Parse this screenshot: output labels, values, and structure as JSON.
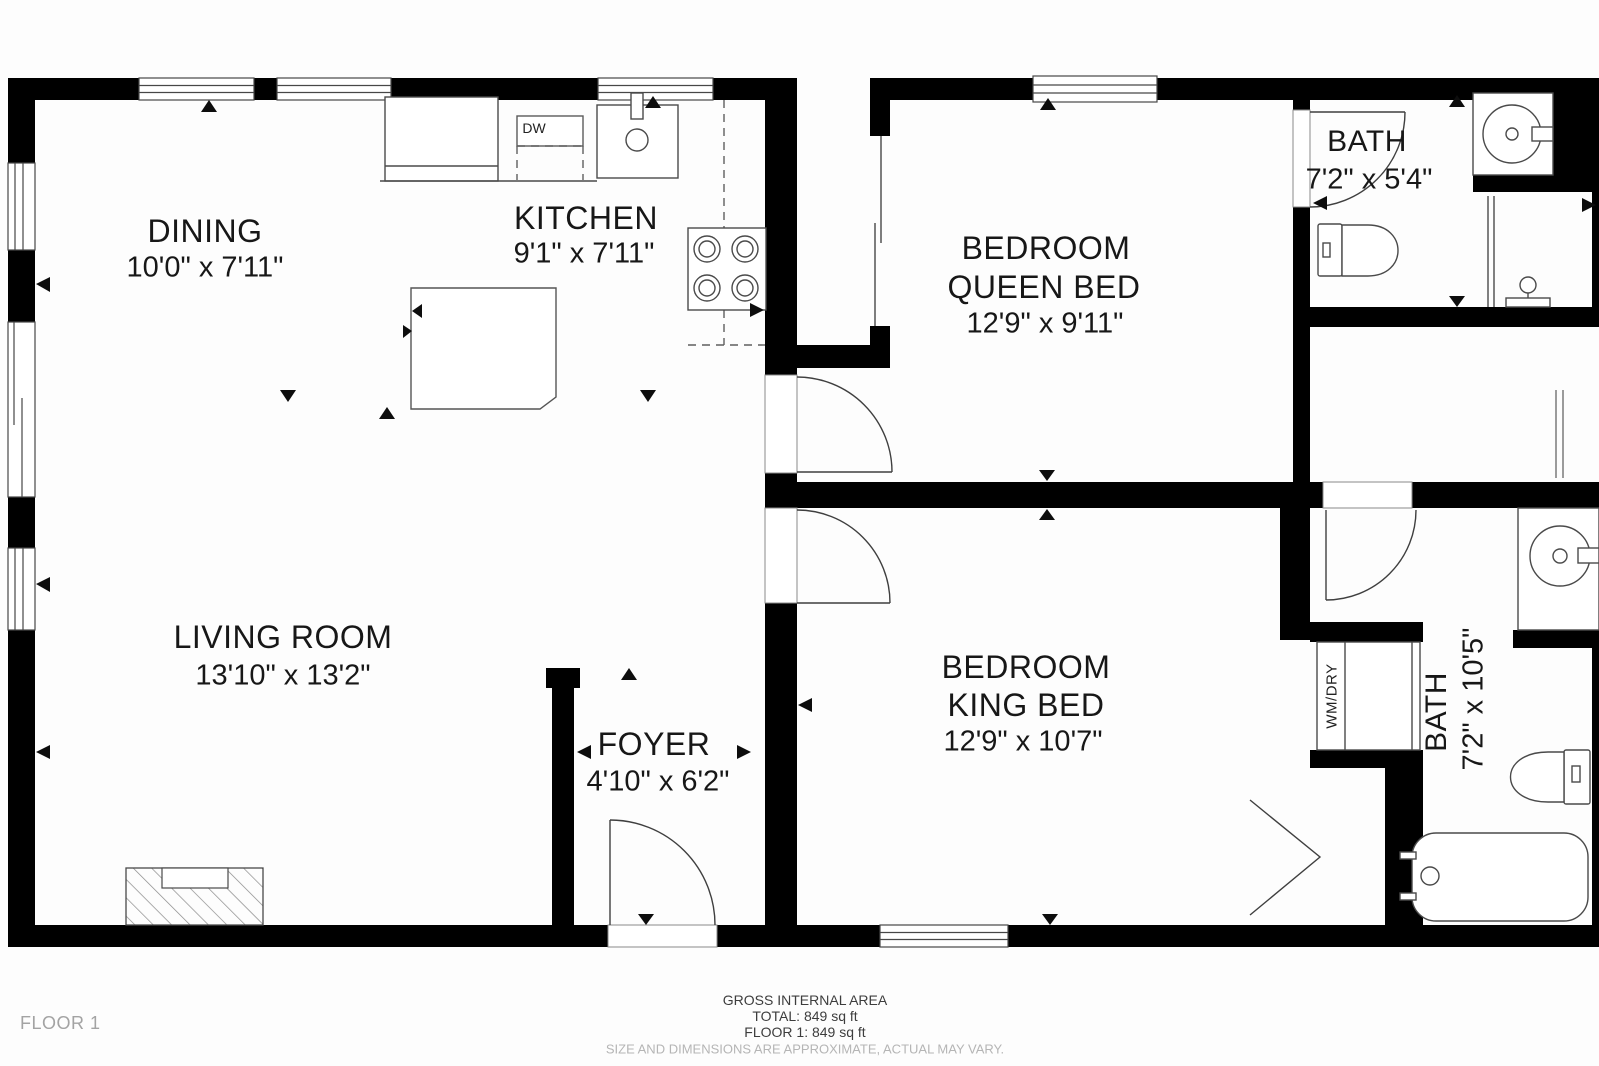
{
  "plan": {
    "floor_label": "FLOOR 1",
    "rooms": {
      "dining": {
        "name": "DINING",
        "dims": "10'0\" x 7'11\""
      },
      "kitchen": {
        "name": "KITCHEN",
        "dims": "9'1\" x 7'11\""
      },
      "living": {
        "name": "LIVING ROOM",
        "dims": "13'10\" x 13'2\""
      },
      "foyer": {
        "name": "FOYER",
        "dims": "4'10\" x 6'2\""
      },
      "bedroom_queen": {
        "name": "BEDROOM",
        "bed": "QUEEN BED",
        "dims": "12'9\" x 9'11\""
      },
      "bedroom_king": {
        "name": "BEDROOM",
        "bed": "KING BED",
        "dims": "12'9\" x 10'7\""
      },
      "bath_top": {
        "name": "BATH",
        "dims": "7'2\" x 5'4\""
      },
      "bath_bottom": {
        "name": "BATH",
        "dims": "7'2\" x 10'5\""
      }
    },
    "fixtures": {
      "dishwasher": "DW",
      "washer_dryer": "WM/DRY"
    },
    "footer": {
      "gross": "GROSS INTERNAL AREA",
      "total": "TOTAL: 849 sq ft",
      "floor1": "FLOOR 1: 849 sq ft",
      "disclaimer": "SIZE AND DIMENSIONS ARE APPROXIMATE, ACTUAL MAY VARY."
    },
    "colors": {
      "wall": "#000000",
      "line": "#4a4a4a",
      "text": "#171717",
      "muted": "#a3a3a3"
    }
  }
}
